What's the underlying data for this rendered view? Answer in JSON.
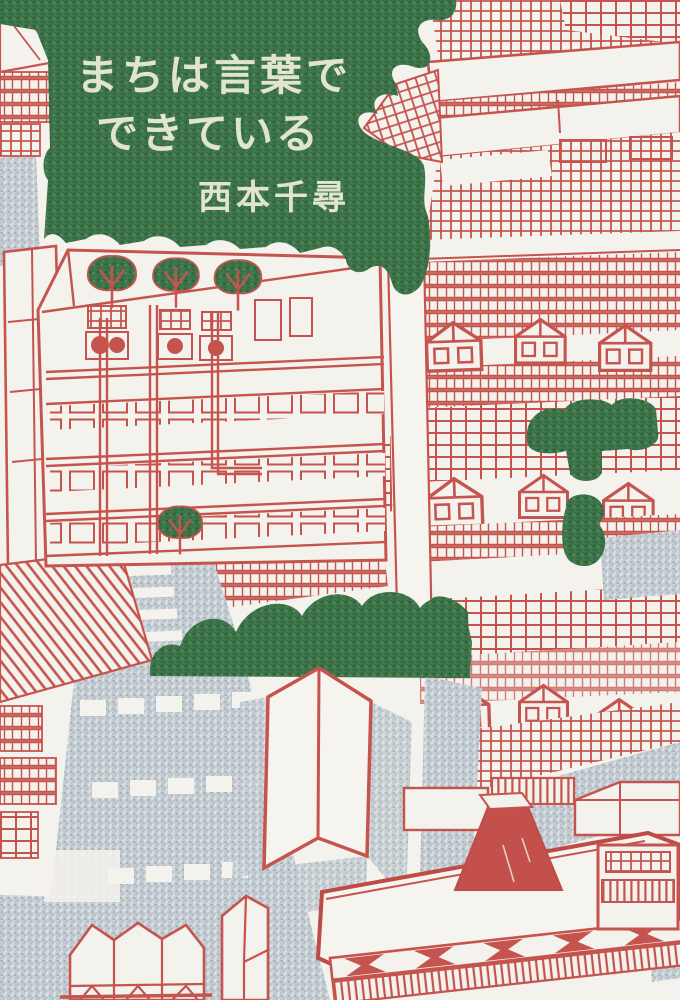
{
  "cover": {
    "title": {
      "line1": "まちは言葉で",
      "line2": "できている"
    },
    "author": {
      "name": "西本千尋"
    },
    "publisher": {
      "name": "柏書房"
    },
    "palette": {
      "paper": "#f4f2ec",
      "line_red": "#c5544f",
      "fill_red": "#c3504b",
      "tree_green": "#3e7449",
      "road_gray": "#c3cbd1",
      "title_text": "#e1e5d0",
      "publisher_text": "#3d4247"
    }
  }
}
